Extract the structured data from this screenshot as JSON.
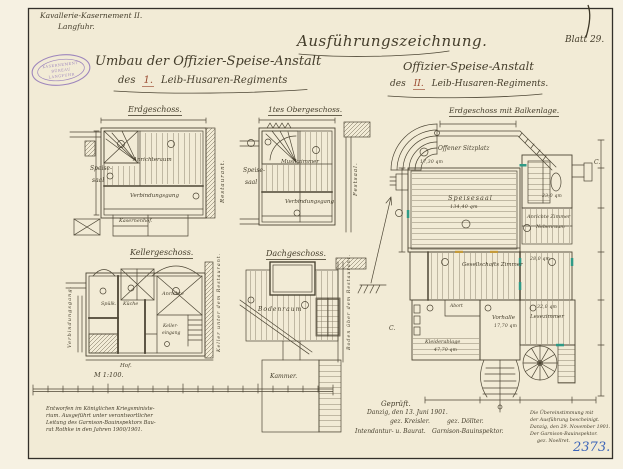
{
  "sheet": {
    "corner": {
      "line1": "Kavallerie-Kasernement II.",
      "line2": "Langfuhr."
    },
    "stamp": {
      "line1": "KASERNEMENT",
      "line2": "BÜREAU",
      "line3": "LANGFUHR"
    },
    "title_center": "Ausführungszeichnung.",
    "left_title": {
      "line1": "Umbau der Offizier-Speise-Anstalt",
      "prefix": "des",
      "number": "1.",
      "suffix": "Leib-Husaren-Regiments"
    },
    "right_title": {
      "line1": "Offizier-Speise-Anstalt",
      "prefix": "des",
      "number": "II.",
      "suffix": "Leib-Husaren-Regiments."
    },
    "blatt_label": "Blatt 29.",
    "corner_mark": "1",
    "archive_number": "2373."
  },
  "plans": {
    "erdgeschoss": {
      "title": "Erdgeschoss.",
      "speisesaal1": "Speise-",
      "speisesaal2": "saal",
      "anrichteraum": "Anrichteraum",
      "verbindungsgang": "Verbindungsgang",
      "restaurant": "Restaurant.",
      "kasernenhof": "Kasernenhof."
    },
    "obergeschoss": {
      "title": "1tes Obergeschoss.",
      "speisesaal1": "Speise-",
      "speisesaal2": "saal",
      "musikzimmer": "Musikzimmer",
      "verbindungsgang": "Verbindungsgang.",
      "festsaal": "Festsaal."
    },
    "kellergeschoss": {
      "title": "Kellergeschoss.",
      "verbindungsgang": "Verbindungsgang.",
      "spuelkueche": "Spülk.",
      "kueche": "Küche",
      "anrichte": "Anrichte",
      "kellereingang1": "Keller-",
      "kellereingang2": "eingang",
      "hof": "Hof.",
      "keller_unter": "Keller unter dem Restaurant."
    },
    "dachgeschoss": {
      "title": "Dachgeschoss.",
      "bodenraum": "Bodenraum",
      "kammer": "Kammer.",
      "boden_ueber": "Boden über dem Restaurant."
    },
    "hauptplan": {
      "title": "Erdgeschoss mit Balkenlage.",
      "offener_sitzplatz": "Offener Sitzplatz",
      "sitzplatz_flaeche": "17,30 qm",
      "speisesaal": "Speisesaal",
      "speisesaal_flaeche": "134,40 qm",
      "raum_23": "23,0 qm",
      "anrichte_zimmer": "Anrichte Zimmer",
      "nebenraum": "Nebenraum",
      "gesellschafts_zimmer": "Gesellschafts Zimmer",
      "raum_28": "28,0 qm",
      "abort": "Abort",
      "vorhalle": "Vorhalle",
      "vorhalle_flaeche": "17,70 qm",
      "lesezimmer": "Lesezimmer",
      "lesezimmer_flaeche": "32,0 qm",
      "kleiderablage": "Kleiderablage",
      "kleiderablage_flaeche": "47,70 qm",
      "section_c_left": "C.",
      "section_c_right": "C."
    }
  },
  "scale": {
    "label": "M 1:100."
  },
  "footer": {
    "note": [
      "Entworfen im Königlichen Kriegsministe-",
      "rium. Ausgeführt unter verantwortlicher",
      "Leitung des Garnison-Bauinspektors Bau-",
      "rat Rothke in den Jahren 1900/1901."
    ],
    "geprueft": "Geprüft.",
    "ort_datum": "Danzig, den 13. Juni 1901.",
    "sig_left": "gez. Kreisler.",
    "sig_right": "gez. Döllter.",
    "titel_left": "Intendantur- u. Baurat.",
    "titel_right": "Garnison-Bauinspektor.",
    "bestaetigung": [
      "Die Übereinstimmung mit",
      "der Ausführung bescheinigt.",
      "Danzig, den 29. November 1901.",
      "Der Garnison-Bauinspektor.",
      "gez. Noellret."
    ]
  },
  "colors": {
    "ink": "#4d4635",
    "red": "#9a4a30",
    "blue": "#3c64b8",
    "stamp": "#8f74b8",
    "teal": "#2f9a86",
    "paper": "#f2ebd6"
  }
}
